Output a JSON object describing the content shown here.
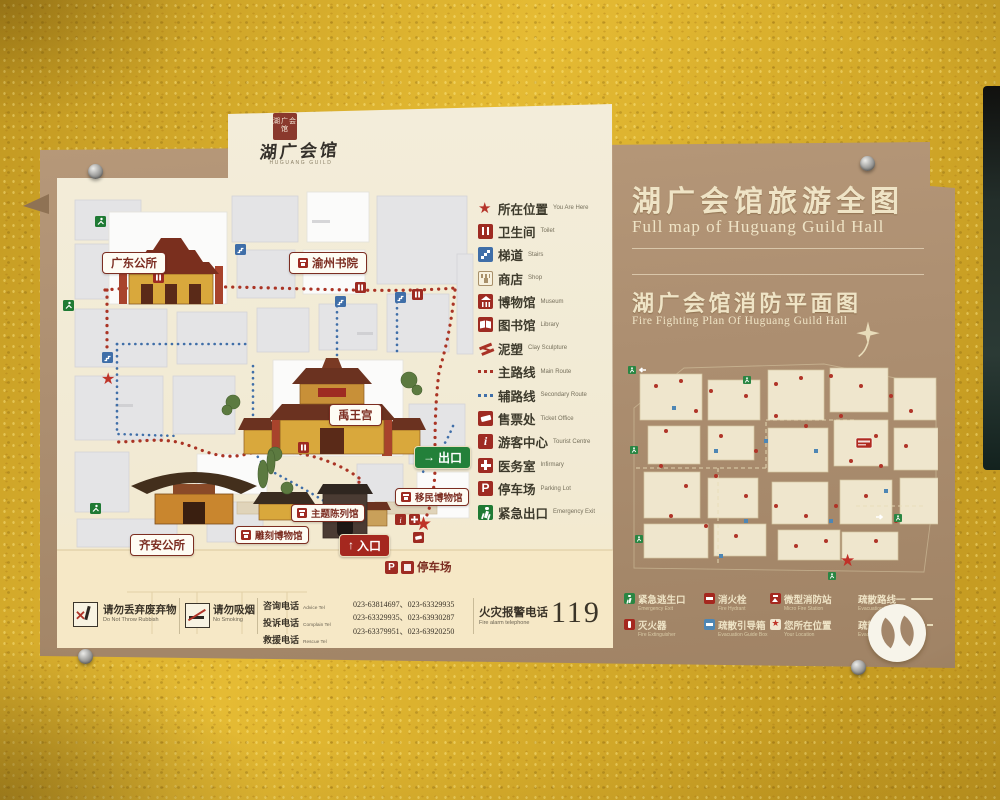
{
  "logo": {
    "seal_text": "湖广会馆",
    "calligraphy": "湖广会馆",
    "subtext": "HUGUANG GUILD"
  },
  "panel": {
    "title_cn": "湖广会馆旅游全图",
    "title_en": "Full map of Huguang Guild Hall",
    "fire_title_cn": "湖广会馆消防平面图",
    "fire_title_en": "Fire Fighting Plan Of Huguang Guild Hall"
  },
  "legend": {
    "items": [
      {
        "icon": "star",
        "cn": "所在位置",
        "en": "You Are Here"
      },
      {
        "icon": "toilet",
        "cn": "卫生间",
        "en": "Toilet"
      },
      {
        "icon": "stairs",
        "cn": "梯道",
        "en": "Stairs"
      },
      {
        "icon": "shop",
        "cn": "商店",
        "en": "Shop"
      },
      {
        "icon": "museum",
        "cn": "博物馆",
        "en": "Museum"
      },
      {
        "icon": "library",
        "cn": "图书馆",
        "en": "Library"
      },
      {
        "icon": "sculpture",
        "cn": "泥塑",
        "en": "Clay Sculpture"
      },
      {
        "icon": "main-route",
        "cn": "主路线",
        "en": "Main Route"
      },
      {
        "icon": "secondary-route",
        "cn": "辅路线",
        "en": "Secondary Route"
      },
      {
        "icon": "ticket",
        "cn": "售票处",
        "en": "Ticket Office"
      },
      {
        "icon": "info",
        "cn": "游客中心",
        "en": "Tourist Centre"
      },
      {
        "icon": "infirmary",
        "cn": "医务室",
        "en": "Infirmary"
      },
      {
        "icon": "parking",
        "cn": "停车场",
        "en": "Parking Lot"
      },
      {
        "icon": "emergency",
        "cn": "紧急出口",
        "en": "Emergency Exit"
      }
    ]
  },
  "map": {
    "labels": {
      "guangdong": "广东公所",
      "yuzhou": "渝州书院",
      "yuwang": "禹王宫",
      "qian": "齐安公所",
      "carving": "雕刻博物馆",
      "theme": "主题陈列馆",
      "migration": "移民博物馆"
    },
    "exit": "出口",
    "exit_arrow": "→",
    "entrance": "入口",
    "entrance_arrow": "↑",
    "parking": "停车场"
  },
  "notices": {
    "rubbish_cn": "请勿丢弃废弃物",
    "rubbish_en": "Do Not Throw Rubbish",
    "smoking_cn": "请勿吸烟",
    "smoking_en": "No Smoking"
  },
  "phones": {
    "advice_cn": "咨询电话",
    "advice_en": "Advice Tel",
    "advice_no": "023-63814697、023-63329935",
    "complain_cn": "投诉电话",
    "complain_en": "Complain Tel",
    "complain_no": "023-63329935、023-63930287",
    "rescue_cn": "救援电话",
    "rescue_en": "Rescue Tel",
    "rescue_no": "023-63379951、023-63920250",
    "fire_cn": "火灾报警电话",
    "fire_en": "Fire alarm telephone",
    "fire_no": "119"
  },
  "fire_legend": {
    "items": [
      {
        "icon": "exit-green",
        "cn": "紧急逃生口",
        "en": "Emergency Exit"
      },
      {
        "icon": "hydrant",
        "cn": "消火栓",
        "en": "Fire Hydrant"
      },
      {
        "icon": "station",
        "cn": "微型消防站",
        "en": "Micro Fire Station"
      },
      {
        "icon": "route1",
        "cn": "疏散路线一",
        "en": "Evacuation Route 1"
      },
      {
        "icon": "extinguisher",
        "cn": "灭火器",
        "en": "Fire Extinguisher"
      },
      {
        "icon": "guide-box",
        "cn": "疏散引导箱",
        "en": "Evacuation Guide Box"
      },
      {
        "icon": "location-star",
        "cn": "您所在位置",
        "en": "Your Location"
      },
      {
        "icon": "route2",
        "cn": "疏散路线二",
        "en": "Evacuation Route 2"
      }
    ]
  },
  "colors": {
    "wall_yellow": "#dfb32a",
    "board_brown": "#ad8f71",
    "panel_cream": "#f2ead3",
    "accent_red": "#9e2b22",
    "route_red": "#a93226",
    "route_blue": "#3f6ea8",
    "exit_green": "#1f7a34",
    "title_cream": "#efe4c6"
  }
}
